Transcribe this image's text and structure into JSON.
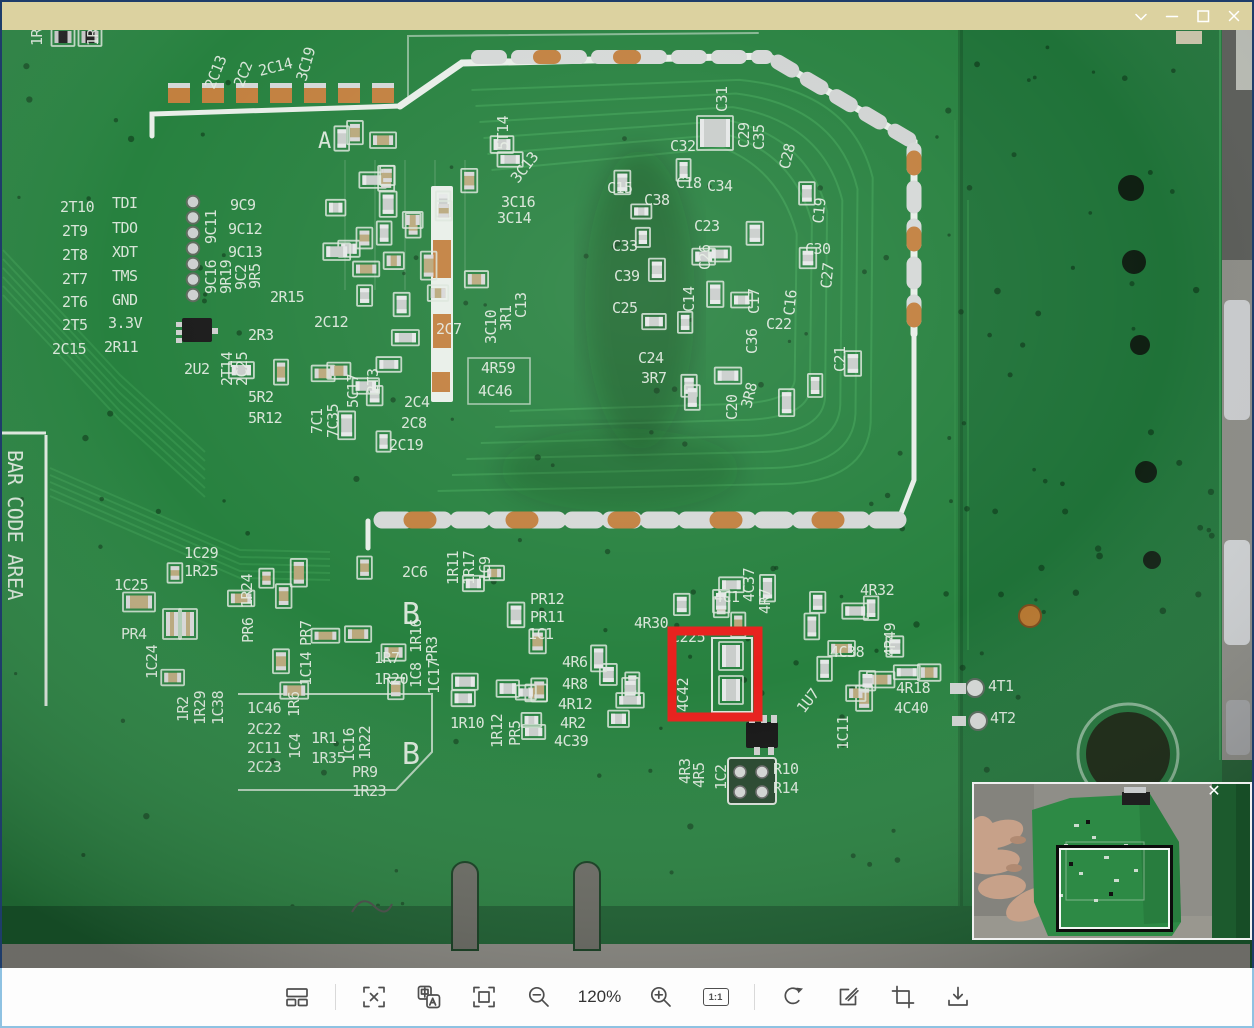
{
  "window": {
    "title": "",
    "titlebar_color": "#dcd2a0",
    "controls": [
      "chevron-down",
      "minimize",
      "maximize",
      "close"
    ]
  },
  "toolbar": {
    "zoom_level": "120%",
    "actual_size_label": "1:1",
    "icons": [
      "thumbnails",
      "screenshot-select",
      "translate",
      "fit-window",
      "zoom-out",
      "zoom-in",
      "original-size",
      "rotate",
      "edit",
      "crop",
      "save"
    ]
  },
  "minimap": {
    "close_icon": "✕"
  },
  "annotation": {
    "x": 672,
    "y": 631,
    "width": 86,
    "height": 86,
    "color": "#e8201c",
    "thickness": 9
  },
  "pcb": {
    "colors": {
      "board": "#27813f",
      "board_dark": "#1f7238",
      "silkscreen": "#e7eee5",
      "pad_copper": "#c2803f",
      "pad_silver": "#d5d8d7",
      "floor": "#8e8d86"
    },
    "silkscreen_labels": [
      {
        "t": "1R",
        "x": 42,
        "y": 46,
        "r": -90
      },
      {
        "t": "1R",
        "x": 98,
        "y": 46,
        "r": -90
      },
      {
        "t": "2C13",
        "x": 214,
        "y": 90,
        "r": -68
      },
      {
        "t": "2C2",
        "x": 243,
        "y": 88,
        "r": -68
      },
      {
        "t": "2C14",
        "x": 260,
        "y": 76,
        "r": -14
      },
      {
        "t": "3C19",
        "x": 306,
        "y": 82,
        "r": -74
      },
      {
        "t": "A",
        "x": 318,
        "y": 148,
        "s": 22
      },
      {
        "t": "2T10",
        "x": 60,
        "y": 212
      },
      {
        "t": "TDI",
        "x": 112,
        "y": 208
      },
      {
        "t": "2T9",
        "x": 62,
        "y": 236
      },
      {
        "t": "TDO",
        "x": 112,
        "y": 233
      },
      {
        "t": "2T8",
        "x": 62,
        "y": 260
      },
      {
        "t": "XDT",
        "x": 112,
        "y": 257
      },
      {
        "t": "2T7",
        "x": 62,
        "y": 284
      },
      {
        "t": "TMS",
        "x": 112,
        "y": 281
      },
      {
        "t": "2T6",
        "x": 62,
        "y": 307
      },
      {
        "t": "GND",
        "x": 112,
        "y": 305
      },
      {
        "t": "2T5",
        "x": 62,
        "y": 330
      },
      {
        "t": "3.3V",
        "x": 108,
        "y": 328
      },
      {
        "t": "2C15",
        "x": 52,
        "y": 354
      },
      {
        "t": "2R11",
        "x": 104,
        "y": 352
      },
      {
        "t": "9C11",
        "x": 216,
        "y": 244,
        "r": -90
      },
      {
        "t": "9C9",
        "x": 230,
        "y": 210
      },
      {
        "t": "9C12",
        "x": 228,
        "y": 234
      },
      {
        "t": "9C13",
        "x": 228,
        "y": 257
      },
      {
        "t": "9C16",
        "x": 216,
        "y": 294,
        "r": -90
      },
      {
        "t": "9R19",
        "x": 231,
        "y": 294,
        "r": -90
      },
      {
        "t": "9C2",
        "x": 246,
        "y": 290,
        "r": -90
      },
      {
        "t": "9R5",
        "x": 260,
        "y": 289,
        "r": -90
      },
      {
        "t": "2R15",
        "x": 270,
        "y": 302
      },
      {
        "t": "2C12",
        "x": 314,
        "y": 327
      },
      {
        "t": "2R3",
        "x": 248,
        "y": 340
      },
      {
        "t": "2U2",
        "x": 184,
        "y": 374
      },
      {
        "t": "2T14",
        "x": 232,
        "y": 386,
        "r": -90
      },
      {
        "t": "2C25",
        "x": 247,
        "y": 386,
        "r": -90
      },
      {
        "t": "5R2",
        "x": 248,
        "y": 402
      },
      {
        "t": "5R12",
        "x": 248,
        "y": 423
      },
      {
        "t": "7C1",
        "x": 322,
        "y": 434,
        "r": -90
      },
      {
        "t": "7C35",
        "x": 338,
        "y": 438,
        "r": -90
      },
      {
        "t": "5C17",
        "x": 358,
        "y": 408,
        "r": -90
      },
      {
        "t": "2T3",
        "x": 378,
        "y": 394,
        "r": -90
      },
      {
        "t": "2C4",
        "x": 404,
        "y": 407
      },
      {
        "t": "2C8",
        "x": 401,
        "y": 428
      },
      {
        "t": "2C19",
        "x": 389,
        "y": 450
      },
      {
        "t": "2C7",
        "x": 436,
        "y": 334
      },
      {
        "t": "3C10",
        "x": 496,
        "y": 344,
        "r": -90
      },
      {
        "t": "3R1",
        "x": 511,
        "y": 331,
        "r": -90
      },
      {
        "t": "C13",
        "x": 526,
        "y": 318,
        "r": -90
      },
      {
        "t": "4R59",
        "x": 481,
        "y": 373
      },
      {
        "t": "4C46",
        "x": 478,
        "y": 396
      },
      {
        "t": "5T14",
        "x": 508,
        "y": 150,
        "r": -90
      },
      {
        "t": "3C13",
        "x": 518,
        "y": 184,
        "r": -52
      },
      {
        "t": "3C16",
        "x": 501,
        "y": 207
      },
      {
        "t": "3C14",
        "x": 497,
        "y": 223
      },
      {
        "t": "C32",
        "x": 670,
        "y": 151
      },
      {
        "t": "C31",
        "x": 727,
        "y": 112,
        "r": -90
      },
      {
        "t": "C29",
        "x": 749,
        "y": 148,
        "r": -90
      },
      {
        "t": "C35",
        "x": 764,
        "y": 150,
        "r": -90
      },
      {
        "t": "C28",
        "x": 789,
        "y": 170,
        "r": -76
      },
      {
        "t": "C15",
        "x": 607,
        "y": 193
      },
      {
        "t": "C38",
        "x": 644,
        "y": 205
      },
      {
        "t": "C18",
        "x": 676,
        "y": 188
      },
      {
        "t": "C34",
        "x": 707,
        "y": 191
      },
      {
        "t": "C23",
        "x": 694,
        "y": 231
      },
      {
        "t": "C19",
        "x": 823,
        "y": 224,
        "r": -84
      },
      {
        "t": "C33",
        "x": 612,
        "y": 251
      },
      {
        "t": "C26",
        "x": 710,
        "y": 270,
        "r": -90
      },
      {
        "t": "C30",
        "x": 805,
        "y": 254
      },
      {
        "t": "C27",
        "x": 831,
        "y": 289,
        "r": -84
      },
      {
        "t": "C39",
        "x": 614,
        "y": 281
      },
      {
        "t": "C14",
        "x": 694,
        "y": 312,
        "r": -90
      },
      {
        "t": "C25",
        "x": 612,
        "y": 313
      },
      {
        "t": "C17",
        "x": 759,
        "y": 314,
        "r": -90
      },
      {
        "t": "C16",
        "x": 794,
        "y": 316,
        "r": -84
      },
      {
        "t": "C22",
        "x": 766,
        "y": 329
      },
      {
        "t": "C36",
        "x": 757,
        "y": 354,
        "r": -90
      },
      {
        "t": "C21",
        "x": 845,
        "y": 372,
        "r": -90
      },
      {
        "t": "C24",
        "x": 638,
        "y": 363
      },
      {
        "t": "3R7",
        "x": 641,
        "y": 383
      },
      {
        "t": "C20",
        "x": 737,
        "y": 420,
        "r": -90
      },
      {
        "t": "3R8",
        "x": 751,
        "y": 409,
        "r": -76
      },
      {
        "t": "1C29",
        "x": 184,
        "y": 558
      },
      {
        "t": "1R25",
        "x": 184,
        "y": 576
      },
      {
        "t": "2C6",
        "x": 402,
        "y": 577
      },
      {
        "t": "1R11",
        "x": 458,
        "y": 585,
        "r": -90
      },
      {
        "t": "1R17",
        "x": 474,
        "y": 585,
        "r": -90
      },
      {
        "t": "1C9",
        "x": 490,
        "y": 582,
        "r": -90
      },
      {
        "t": "B",
        "x": 402,
        "y": 624,
        "s": 30
      },
      {
        "t": "B",
        "x": 402,
        "y": 764,
        "s": 30
      },
      {
        "t": "PR12",
        "x": 530,
        "y": 604
      },
      {
        "t": "PR11",
        "x": 530,
        "y": 622
      },
      {
        "t": "1C1",
        "x": 528,
        "y": 639
      },
      {
        "t": "4R30",
        "x": 634,
        "y": 628
      },
      {
        "t": "C225",
        "x": 671,
        "y": 642
      },
      {
        "t": "4C1",
        "x": 714,
        "y": 602
      },
      {
        "t": "4C37",
        "x": 754,
        "y": 602,
        "r": -90
      },
      {
        "t": "4R7",
        "x": 770,
        "y": 614,
        "r": -90
      },
      {
        "t": "4C42",
        "x": 688,
        "y": 712,
        "r": -90
      },
      {
        "t": "1C25",
        "x": 114,
        "y": 590
      },
      {
        "t": "PR4",
        "x": 121,
        "y": 639
      },
      {
        "t": "1C24",
        "x": 157,
        "y": 679,
        "r": -90
      },
      {
        "t": "1R24",
        "x": 252,
        "y": 608,
        "r": -90
      },
      {
        "t": "PR6",
        "x": 253,
        "y": 643,
        "r": -90
      },
      {
        "t": "PR7",
        "x": 311,
        "y": 646,
        "r": -90
      },
      {
        "t": "1C14",
        "x": 311,
        "y": 686,
        "r": -90
      },
      {
        "t": "1R7",
        "x": 374,
        "y": 663
      },
      {
        "t": "1R20",
        "x": 374,
        "y": 684
      },
      {
        "t": "1R16",
        "x": 421,
        "y": 653,
        "r": -90
      },
      {
        "t": "1C8",
        "x": 421,
        "y": 688,
        "r": -90
      },
      {
        "t": "PR3",
        "x": 437,
        "y": 662,
        "r": -90
      },
      {
        "t": "1C17",
        "x": 439,
        "y": 694,
        "r": -90
      },
      {
        "t": "1R10",
        "x": 450,
        "y": 728
      },
      {
        "t": "1R12",
        "x": 502,
        "y": 748,
        "r": -90
      },
      {
        "t": "PR5",
        "x": 520,
        "y": 746,
        "r": -90
      },
      {
        "t": "4R6",
        "x": 562,
        "y": 667
      },
      {
        "t": "4R8",
        "x": 562,
        "y": 689
      },
      {
        "t": "4R12",
        "x": 558,
        "y": 709
      },
      {
        "t": "4R2",
        "x": 560,
        "y": 728
      },
      {
        "t": "4C39",
        "x": 554,
        "y": 746
      },
      {
        "t": "1R2",
        "x": 188,
        "y": 722,
        "r": -90
      },
      {
        "t": "1R29",
        "x": 205,
        "y": 725,
        "r": -90
      },
      {
        "t": "1C38",
        "x": 223,
        "y": 725,
        "r": -90
      },
      {
        "t": "1C46",
        "x": 247,
        "y": 713
      },
      {
        "t": "1R6",
        "x": 299,
        "y": 717,
        "r": -90
      },
      {
        "t": "2C22",
        "x": 247,
        "y": 734
      },
      {
        "t": "2C11",
        "x": 247,
        "y": 753
      },
      {
        "t": "1C4",
        "x": 300,
        "y": 759,
        "r": -90
      },
      {
        "t": "1R1",
        "x": 311,
        "y": 743
      },
      {
        "t": "2C23",
        "x": 247,
        "y": 772
      },
      {
        "t": "1R35",
        "x": 311,
        "y": 763
      },
      {
        "t": "1C16",
        "x": 354,
        "y": 762,
        "r": -90
      },
      {
        "t": "1R22",
        "x": 370,
        "y": 760,
        "r": -90
      },
      {
        "t": "PR9",
        "x": 352,
        "y": 777
      },
      {
        "t": "1R23",
        "x": 352,
        "y": 796
      },
      {
        "t": "4R3",
        "x": 690,
        "y": 784,
        "r": -90
      },
      {
        "t": "4R5",
        "x": 704,
        "y": 788,
        "r": -90
      },
      {
        "t": "1C2",
        "x": 726,
        "y": 790,
        "r": -90
      },
      {
        "t": "R10",
        "x": 773,
        "y": 774
      },
      {
        "t": "R14",
        "x": 773,
        "y": 793
      },
      {
        "t": "1U7",
        "x": 804,
        "y": 714,
        "r": -52
      },
      {
        "t": "1C11",
        "x": 848,
        "y": 750,
        "r": -90
      },
      {
        "t": "4C38",
        "x": 830,
        "y": 657
      },
      {
        "t": "4R32",
        "x": 860,
        "y": 595
      },
      {
        "t": "4R49",
        "x": 895,
        "y": 657,
        "r": -90
      },
      {
        "t": "4R18",
        "x": 896,
        "y": 693
      },
      {
        "t": "4C40",
        "x": 894,
        "y": 713
      },
      {
        "t": "4T1",
        "x": 988,
        "y": 691
      },
      {
        "t": "4T2",
        "x": 990,
        "y": 723
      },
      {
        "t": "BAR CODE AREA",
        "x": 8,
        "y": 450,
        "r": 90,
        "s": 20
      }
    ]
  }
}
